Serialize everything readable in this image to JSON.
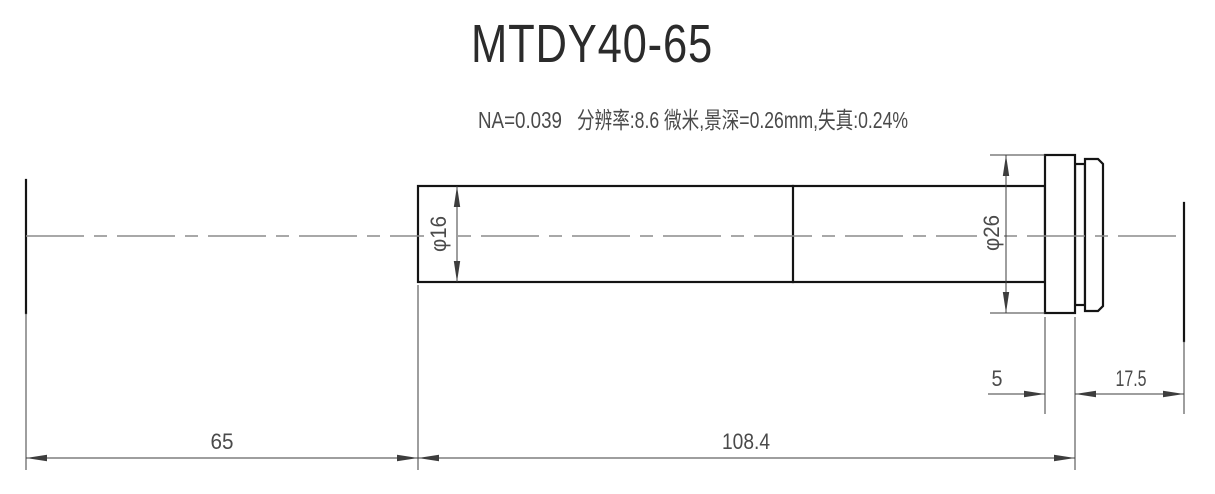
{
  "title": "MTDY40-65",
  "subtitle": {
    "na": "NA=0.039",
    "specs": "分辨率:8.6 微米,景深=0.26mm,失真:0.24%"
  },
  "dimensions": {
    "object_distance": "65",
    "body_length": "108.4",
    "flange_width": "5",
    "image_distance": "17.5",
    "tube_diameter": "φ16",
    "flange_diameter": "φ26"
  },
  "colors": {
    "object_line": "#141414",
    "dimension_line": "#3d3d3d",
    "centerline": "#8c8c8c",
    "text": "#4a4a4a",
    "title": "#2b2b2b",
    "background": "#ffffff"
  }
}
